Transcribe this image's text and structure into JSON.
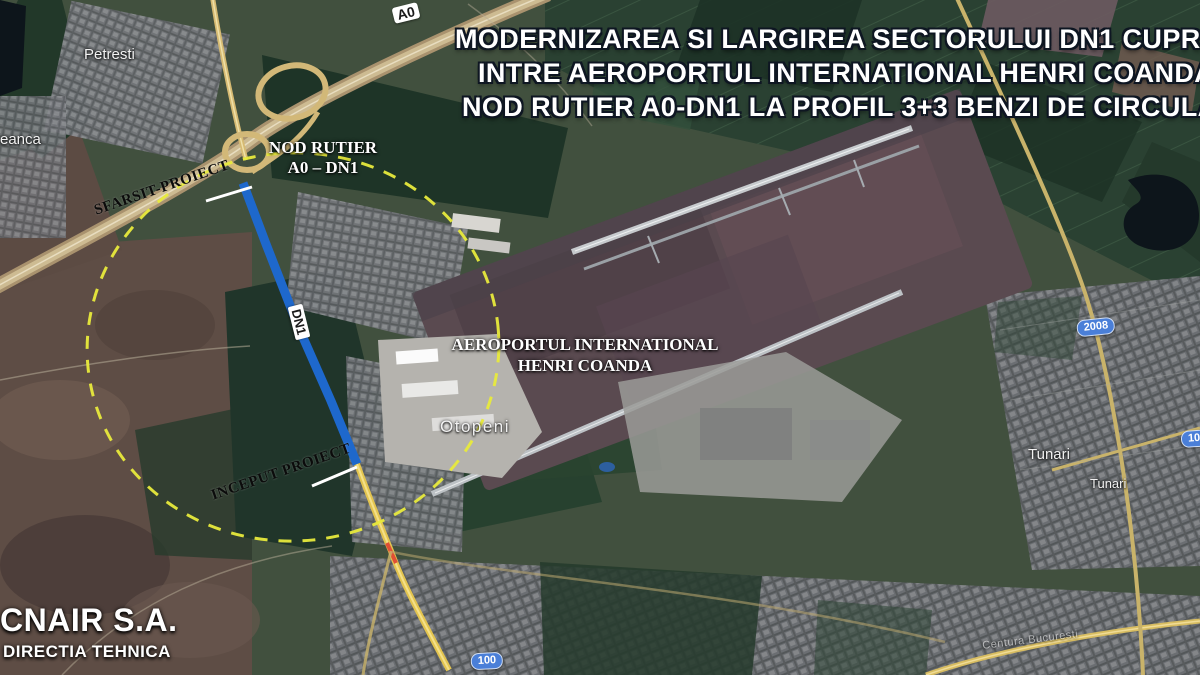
{
  "title": {
    "line1": "MODERNIZAREA SI LARGIREA SECTORULUI DN1 CUPRINS",
    "line2": "INTRE AEROPORTUL INTERNATIONAL HENRI COANDA SI",
    "line3": "NOD RUTIER A0-DN1 LA PROFIL 3+3 BENZI DE CIRCULATIE"
  },
  "annotations": {
    "interchange": {
      "line1": "NOD RUTIER",
      "line2": "A0 – DN1"
    },
    "project_end": "SFARSIT-PROIECT",
    "project_start": "INCEPUT PROIECT",
    "airport": {
      "line1": "AEROPORTUL INTERNATIONAL",
      "line2": "HENRI COANDA"
    }
  },
  "places": {
    "petresti": "Petresti",
    "eanca": "eanca",
    "otopeni": "Otopeni",
    "tunari_upper": "Tunari",
    "tunari_lower": "Tunari",
    "ring_road": "Centura Bucuresti"
  },
  "shields": {
    "a0": "A0",
    "dn1": "DN1",
    "r2008": "2008",
    "r100_east": "100",
    "r100_south": "100"
  },
  "footer": {
    "org": "CNAIR S.A.",
    "dept": "DIRECTIA TEHNICA"
  },
  "colors": {
    "highlight_ellipse": "#e8ea3c",
    "dn1_segment": "#1e68cc",
    "leader_line": "#ffffff",
    "shield_blue": "#4a7fd8",
    "shield_white": "#ffffff",
    "title_text": "#ffffff",
    "project_label_text": "#0b0b0b"
  }
}
